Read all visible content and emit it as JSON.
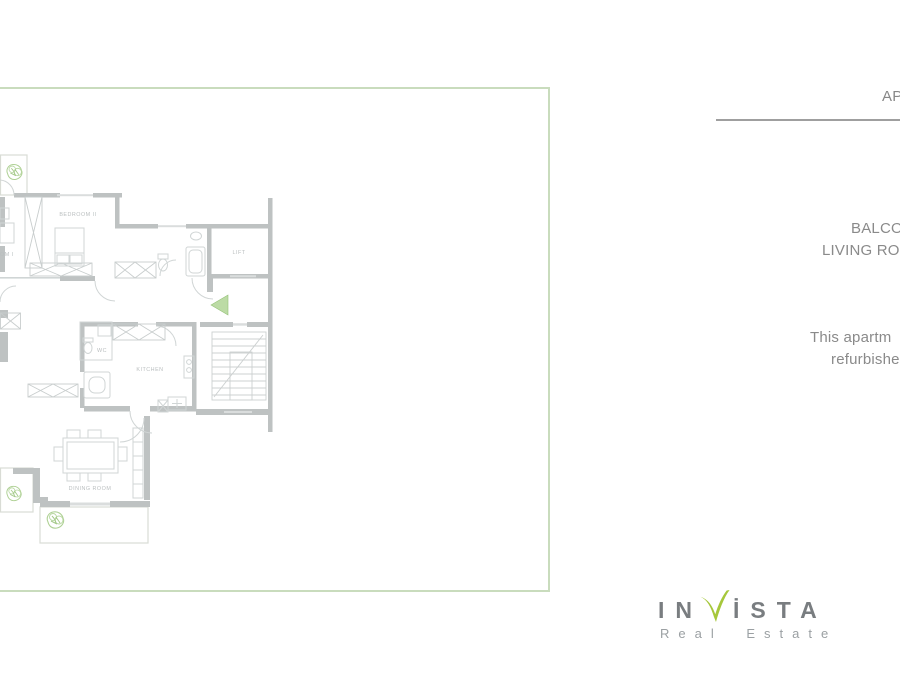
{
  "frame": {
    "border_color": "#c9dcbd"
  },
  "floor_plan": {
    "wall_color": "#b9bdbd",
    "line_color": "#cdd2d2",
    "accent_green": "#a8cd8b",
    "labels": {
      "bedroom2": "BEDROOM II",
      "bedroom1_partial": "OM I",
      "lift": "LIFT",
      "wc": "WC",
      "kitchen": "KITCHEN",
      "dining_room": "DINING ROOM"
    }
  },
  "right_panel": {
    "heading_partial": "AP",
    "room_line1_partial": "BALCO",
    "room_line2_partial": "LIVING RO",
    "description_line1_partial": "This apartm",
    "description_line2_partial": "refurbishe",
    "text_color": "#8a8a8a",
    "rule_color": "#9f9f9f"
  },
  "logo": {
    "word_start": "IN",
    "word_end": "İSTA",
    "tagline": "Real Estate",
    "gray": "#797d80",
    "green": "#a6c73b"
  }
}
